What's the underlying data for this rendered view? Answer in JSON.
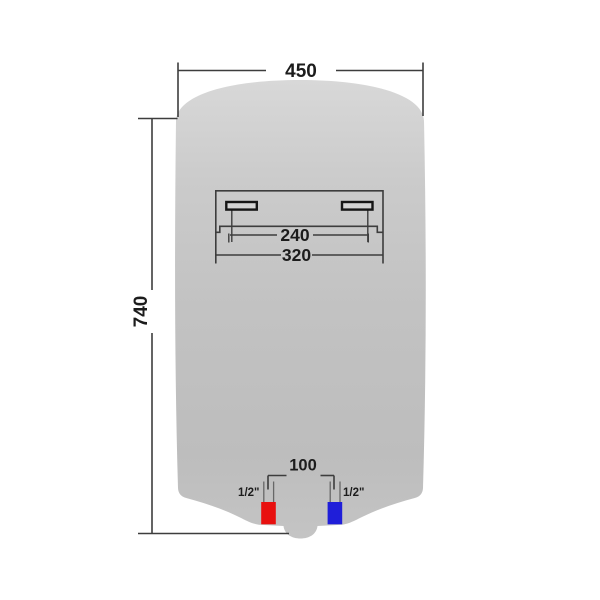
{
  "dimensions": {
    "top_width": "450",
    "left_height": "740",
    "bracket_inner_spacing": "240",
    "bracket_outer_width": "320",
    "pipe_spacing": "100",
    "hot_pipe_label": "1/2\"",
    "cold_pipe_label": "1/2\""
  },
  "colors": {
    "line": "#3d3d3d",
    "text": "#1c1c1c",
    "body_top": "#d8d8d8",
    "body_upper": "#cbcbcb",
    "body_mid": "#c2c2c2",
    "body_lower": "#bdbdbd",
    "body_bottom": "#c4c4c4",
    "bracket_slot_fill": "#d4d4d4",
    "pipe_wall": "#676767",
    "hot_pipe_red": "#e8100f",
    "cold_pipe_blue": "#1f1ed9"
  }
}
